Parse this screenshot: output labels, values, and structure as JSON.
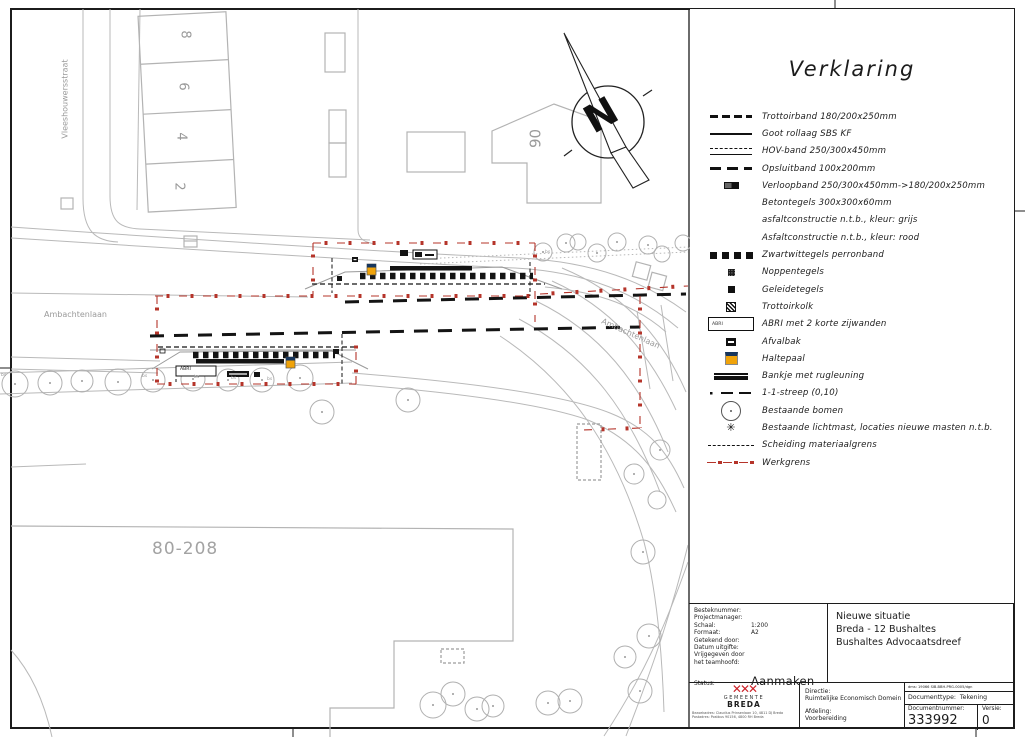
{
  "map": {
    "street_labels": {
      "vleeshouwersstraat": "Vleeshouwersstraat",
      "ambachtenlaan_left": "Ambachtenlaan",
      "ambachtenlaan_right": "Ambachtenlaan"
    },
    "parcel_numbers": [
      "8",
      "6",
      "4",
      "2"
    ],
    "building_labels": {
      "block": "80-208",
      "house": "90"
    },
    "north_arrow_letter": "N",
    "abri_label": "ABRI",
    "bs_labels": [
      "bs",
      "bs",
      "bs",
      "bs",
      "bs",
      "bs"
    ],
    "colors": {
      "workboundary_red": "#b5342a",
      "haltepaal_orange": "#f0a30a",
      "haltepaal_blue": "#17365d",
      "linework_gray": "#b9b9b9"
    }
  },
  "legend": {
    "title": "Verklaring",
    "abri_symbol_text": "ABRI",
    "lightmast_glyph": "✳",
    "items": [
      {
        "symbol": "trottoirband",
        "label": "Trottoirband 180/200x250mm"
      },
      {
        "symbol": "goot",
        "label": "Goot rollaag SBS KF"
      },
      {
        "symbol": "hov",
        "label": "HOV-band 250/300x450mm"
      },
      {
        "symbol": "opsluitband",
        "label": "Opsluitband 100x200mm"
      },
      {
        "symbol": "verloopband",
        "label": "Verloopband 250/300x450mm->180/200x250mm"
      },
      {
        "symbol": "none",
        "label": "Betontegels 300x300x60mm"
      },
      {
        "symbol": "none",
        "label": "asfaltconstructie n.t.b., kleur: grijs"
      },
      {
        "symbol": "none",
        "label": "Asfaltconstructie n.t.b., kleur: rood"
      },
      {
        "symbol": "zwartwit",
        "label": "Zwartwittegels perronband"
      },
      {
        "symbol": "noppen",
        "label": "Noppentegels"
      },
      {
        "symbol": "geleide",
        "label": "Geleidetegels"
      },
      {
        "symbol": "kolk",
        "label": "Trottoirkolk"
      },
      {
        "symbol": "abri",
        "label": "ABRI met 2 korte zijwanden"
      },
      {
        "symbol": "afvalbak",
        "label": "Afvalbak"
      },
      {
        "symbol": "haltepaal",
        "label": "Haltepaal"
      },
      {
        "symbol": "bankje",
        "label": "Bankje met rugleuning"
      },
      {
        "symbol": "streep",
        "label": "1-1-streep (0,10)"
      },
      {
        "symbol": "boom",
        "label": "Bestaande bomen"
      },
      {
        "symbol": "lichtmast",
        "label": "Bestaande lichtmast, locaties nieuwe masten n.t.b."
      },
      {
        "symbol": "materiaalgrens",
        "label": "Scheiding materiaalgrens"
      },
      {
        "symbol": "werkgrens",
        "label": "Werkgrens"
      }
    ]
  },
  "title_block": {
    "fields": [
      {
        "label": "Besteknummer:",
        "value": ""
      },
      {
        "label": "Projectmanager:",
        "value": ""
      },
      {
        "label": "Schaal:",
        "value": "1:200"
      },
      {
        "label": "Formaat:",
        "value": "A2"
      },
      {
        "label": "Getekend door:",
        "value": ""
      },
      {
        "label": "Datum uitgifte:",
        "value": ""
      },
      {
        "label": "Vrijgegeven door",
        "value": ""
      },
      {
        "label": "het teamhoofd:",
        "value": ""
      }
    ],
    "status_label": "Status:",
    "status_value": "Aanmaken",
    "title_lines": [
      "Nieuwe situatie",
      "Breda - 12 Bushaltes",
      "Bushaltes Advocaatsdreef"
    ],
    "org": {
      "name_top": "GEMEENTE",
      "name_bottom": "BREDA",
      "address_line1": "Bezoekadres: Claudius Prinsenlaan 10, 4811 DJ Breda",
      "address_line2": "Postadres: Postbus 90156, 4800 RH Breda"
    },
    "directie_label": "Directie:",
    "directie_value": "Ruimtelijke Economisch Domein",
    "afdeling_label": "Afdeling:",
    "afdeling_value": "Voorbereiding",
    "dms_line": "dms: 19066    SIB-BBH-PRG-0005/dgn",
    "documenttype_label": "Documenttype:",
    "documenttype_value": "Tekening",
    "documentnummer_label": "Documentnummer:",
    "documentnummer_value": "333992",
    "versie_label": "Versie:",
    "versie_value": "0"
  }
}
